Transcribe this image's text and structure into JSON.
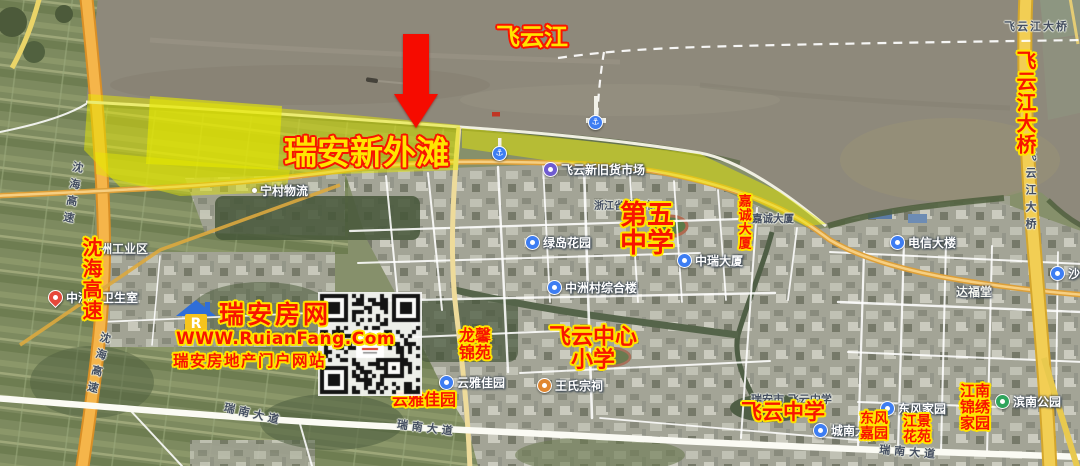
{
  "page": {
    "width": 1080,
    "height": 466
  },
  "colors": {
    "annotation_red": "#f81400",
    "annotation_yellow": "#ffe400",
    "highlight_yellow": "#e6e800",
    "expressway_orange": "#f5b54a",
    "bridge_yellow": "#f2ce54",
    "water_brown": "#8e897b"
  },
  "watermark": {
    "site_name": "瑞安房网",
    "url": "WWW.RuianFang.Com",
    "tagline": "瑞安房地产门户网站",
    "logo_letter": "R"
  },
  "annotations": {
    "labels": [
      {
        "id": "feiyun-river",
        "text": "飞云江",
        "x": 496,
        "y": 25,
        "size": 24,
        "style": "yellow"
      },
      {
        "id": "ruian-new-bund",
        "text": "瑞安新外滩",
        "x": 284,
        "y": 136,
        "size": 33,
        "style": "yellow"
      },
      {
        "id": "feiyunjiang-bridge",
        "text": "飞云江大桥",
        "x": 1014,
        "y": 50,
        "size": 20,
        "style": "red",
        "vertical": true
      },
      {
        "id": "shenhai-expressway",
        "text": "沈海高速",
        "x": 80,
        "y": 237,
        "size": 20,
        "style": "red",
        "vertical": true
      },
      {
        "id": "no5-middle-school",
        "text": "第五\n中学",
        "x": 620,
        "y": 202,
        "size": 27,
        "style": "red"
      },
      {
        "id": "jiacheng-tower",
        "text": "嘉诚大厦",
        "x": 736,
        "y": 194,
        "size": 13,
        "style": "red",
        "vertical": true
      },
      {
        "id": "longxin-jinyuan",
        "text": "龙馨\n锦苑",
        "x": 459,
        "y": 328,
        "size": 16,
        "style": "red"
      },
      {
        "id": "feiyun-central-primary",
        "text": "飞云中心\n小学",
        "x": 549,
        "y": 326,
        "size": 22,
        "style": "red"
      },
      {
        "id": "yunya-jiayuan",
        "text": "云雅佳园",
        "x": 392,
        "y": 392,
        "size": 16,
        "style": "red"
      },
      {
        "id": "feiyun-middle-school",
        "text": "飞云中学",
        "x": 741,
        "y": 401,
        "size": 21,
        "style": "red"
      },
      {
        "id": "dongfeng-jiayuan",
        "text": "东风\n嘉园",
        "x": 860,
        "y": 412,
        "size": 14,
        "style": "red"
      },
      {
        "id": "jiangjing-huayuan",
        "text": "江景\n花苑",
        "x": 903,
        "y": 415,
        "size": 14,
        "style": "red"
      },
      {
        "id": "jiangnan-jinxiu-jiayuan",
        "text": "江南\n锦绣\n家园",
        "x": 960,
        "y": 384,
        "size": 15,
        "style": "red"
      }
    ]
  },
  "map": {
    "pois": [
      {
        "text": "飞云新旧货市场",
        "x": 543,
        "y": 161,
        "icon": "purple"
      },
      {
        "text": "绿岛花园",
        "x": 525,
        "y": 234,
        "icon": "blue"
      },
      {
        "text": "中瑞大厦",
        "x": 677,
        "y": 252,
        "icon": "blue"
      },
      {
        "text": "中洲村综合楼",
        "x": 547,
        "y": 279,
        "icon": "blue"
      },
      {
        "text": "中洲村卫生室",
        "x": 48,
        "y": 289,
        "icon": "pin"
      },
      {
        "text": "电信大楼",
        "x": 890,
        "y": 234,
        "icon": "blue"
      },
      {
        "text": "云雅佳园",
        "x": 439,
        "y": 374,
        "icon": "blue"
      },
      {
        "text": "王氏宗祠",
        "x": 537,
        "y": 377,
        "icon": "orange"
      },
      {
        "text": "东风家园",
        "x": 880,
        "y": 400,
        "icon": "blue"
      },
      {
        "text": "城南大厦",
        "x": 813,
        "y": 422,
        "icon": "blue"
      },
      {
        "text": "滨南公园",
        "x": 995,
        "y": 393,
        "icon": "green"
      },
      {
        "text": "沙塘",
        "x": 1050,
        "y": 265,
        "icon": "blue"
      },
      {
        "text": "宁村物流",
        "x": 252,
        "y": 182,
        "icon": "dot"
      },
      {
        "text": "",
        "x": 492,
        "y": 146,
        "icon": "pier"
      },
      {
        "text": "",
        "x": 588,
        "y": 115,
        "icon": "pier"
      }
    ],
    "labels": [
      {
        "text": "飞云江大桥",
        "x": 1004,
        "y": 18,
        "tone": "dark",
        "size": 11,
        "ls": 2
      },
      {
        "text": "飞云江大桥",
        "x": 1022,
        "y": 150,
        "tone": "dark",
        "size": 11,
        "vertical": true
      },
      {
        "text": "沈海高速",
        "x": 70,
        "y": 160,
        "tone": "dark",
        "size": 11,
        "vertical": true,
        "rot": 10
      },
      {
        "text": "沈海高速",
        "x": 98,
        "y": 330,
        "tone": "dark",
        "size": 11,
        "vertical": true,
        "rot": 14
      },
      {
        "text": "瑞南大道",
        "x": 226,
        "y": 399,
        "tone": "dark",
        "size": 11,
        "rot": 13,
        "ls": 4
      },
      {
        "text": "瑞南大道",
        "x": 398,
        "y": 416,
        "tone": "dark",
        "size": 11,
        "rot": 7,
        "ls": 4
      },
      {
        "text": "瑞南大道",
        "x": 880,
        "y": 441,
        "tone": "dark",
        "size": 11,
        "rot": 5,
        "ls": 4
      },
      {
        "text": "瑞安市 飞云中学",
        "x": 751,
        "y": 391,
        "tone": "dark",
        "size": 11
      },
      {
        "text": "浙江省瑞安市",
        "x": 594,
        "y": 197,
        "tone": "dark",
        "size": 10
      },
      {
        "text": "嘉诚大厦",
        "x": 752,
        "y": 211,
        "tone": "dark",
        "size": 10.5
      },
      {
        "text": "中洲工业区",
        "x": 88,
        "y": 240,
        "tone": "white",
        "size": 12
      },
      {
        "text": "达福堂",
        "x": 956,
        "y": 283,
        "tone": "white",
        "size": 12
      }
    ]
  }
}
